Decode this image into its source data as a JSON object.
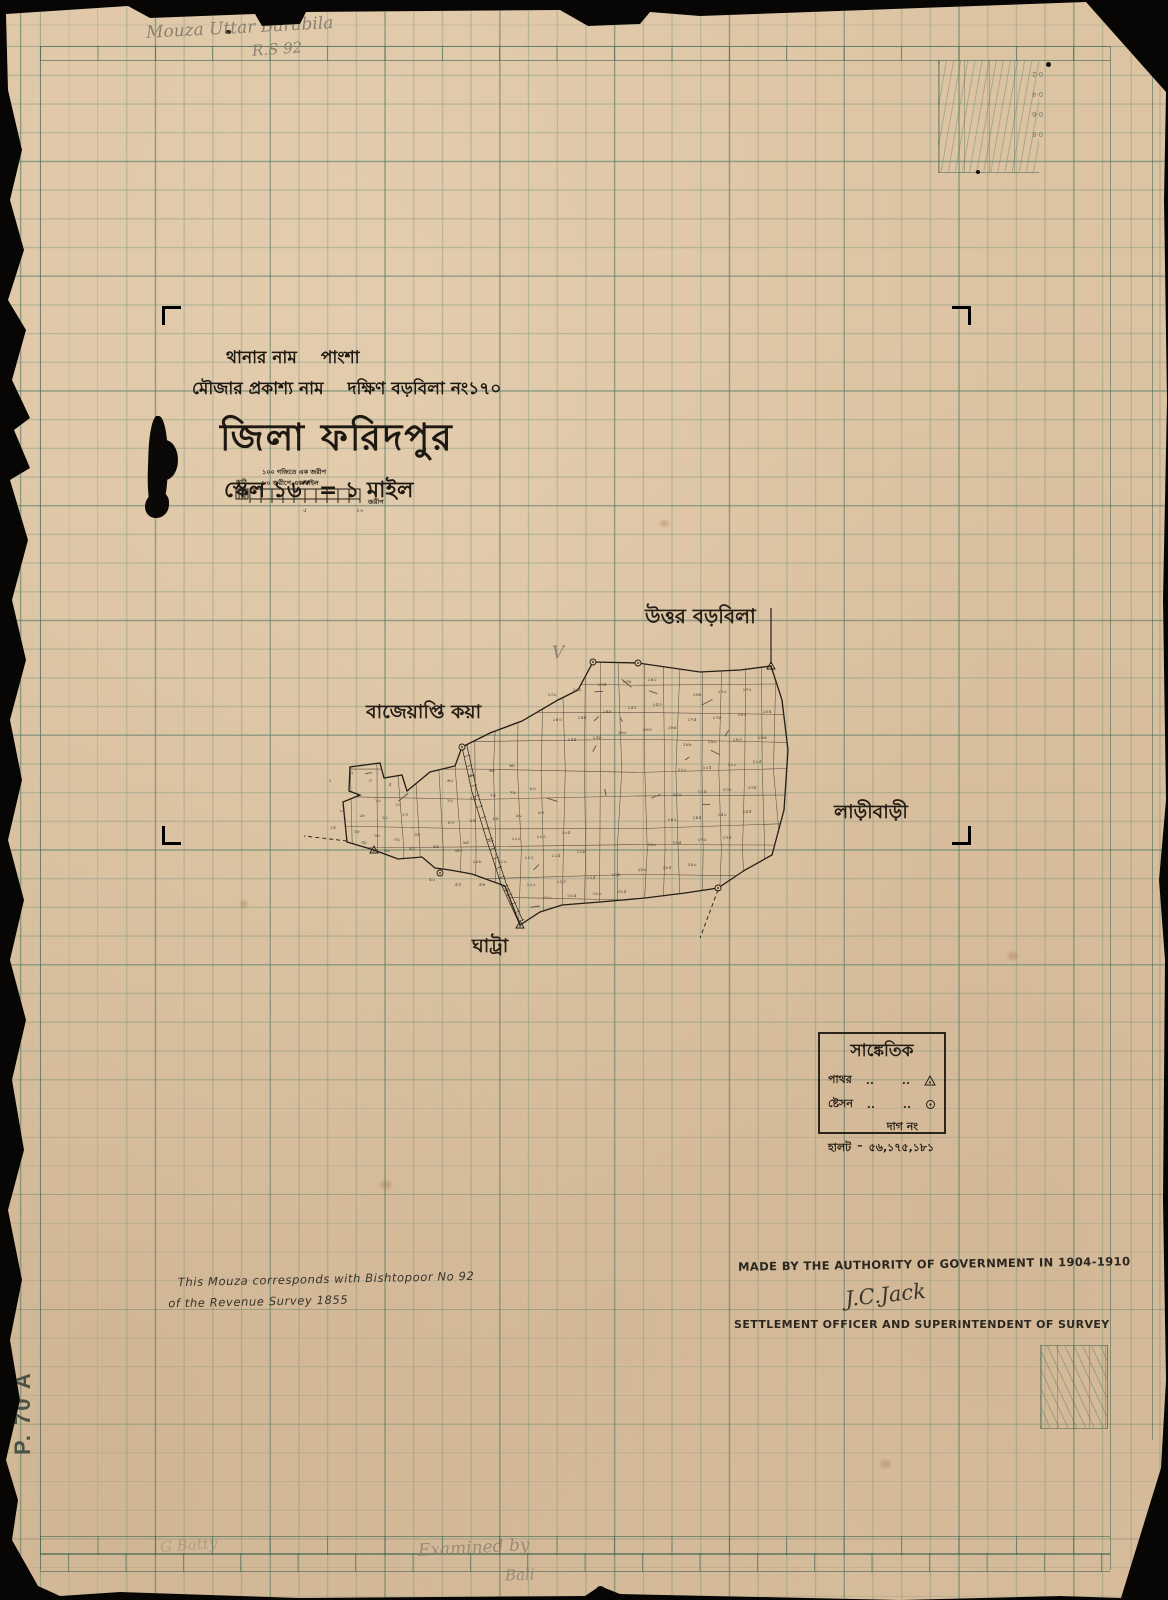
{
  "pencil": {
    "top_line1": "Mouza  Uttar Barabila",
    "top_line2": "R.S 92",
    "check": "V",
    "bottom_faint": "G Batty",
    "bottom_center1": "Examined by",
    "bottom_center2": "Bali"
  },
  "title_block": {
    "line1_label": "থানার নাম",
    "line1_value": "পাংশা",
    "line2_label": "মৌজার প্রকাশ্য নাম",
    "line2_value": "দক্ষিণ বড়বিলা নং১৭০",
    "district": "জিলা ফরিদপুর",
    "scale_line": "স্কেল ১৬″ = ১ মাইল",
    "scale_note1": "১০০ গজিতে এক জরীপ",
    "scale_note2": "৮০ জরীপে এক মাইল",
    "scale_left_label": "কাঠি",
    "scale_right_label": "জরীপ",
    "scale_ticks": [
      "৫",
      "১০"
    ]
  },
  "map": {
    "neighbors": {
      "north": "উত্তর বড়বিলা",
      "west": "বাজেয়াপ্তি কয়া",
      "east": "লাড়ীবাড়ী",
      "south": "ঘাট্রা"
    },
    "plots": [
      {
        "x": 30,
        "y": 182,
        "n": "১"
      },
      {
        "x": 52,
        "y": 174,
        "n": "২"
      },
      {
        "x": 70,
        "y": 182,
        "n": "৩"
      },
      {
        "x": 90,
        "y": 186,
        "n": "৫"
      },
      {
        "x": 58,
        "y": 197,
        "n": "৮"
      },
      {
        "x": 78,
        "y": 202,
        "n": "১০"
      },
      {
        "x": 98,
        "y": 206,
        "n": "১২"
      },
      {
        "x": 42,
        "y": 212,
        "n": "১৫"
      },
      {
        "x": 62,
        "y": 217,
        "n": "১৮"
      },
      {
        "x": 85,
        "y": 219,
        "n": "২১"
      },
      {
        "x": 105,
        "y": 216,
        "n": "২৩"
      },
      {
        "x": 33,
        "y": 229,
        "n": "২৫"
      },
      {
        "x": 57,
        "y": 233,
        "n": "২৮"
      },
      {
        "x": 77,
        "y": 237,
        "n": "৩০"
      },
      {
        "x": 97,
        "y": 241,
        "n": "৩২"
      },
      {
        "x": 117,
        "y": 236,
        "n": "৩৫"
      },
      {
        "x": 64,
        "y": 244,
        "n": "৩৮"
      },
      {
        "x": 87,
        "y": 252,
        "n": "৪০"
      },
      {
        "x": 112,
        "y": 250,
        "n": "৪২"
      },
      {
        "x": 136,
        "y": 248,
        "n": "৪৫"
      },
      {
        "x": 158,
        "y": 252,
        "n": "৪৮"
      },
      {
        "x": 132,
        "y": 281,
        "n": "৫০"
      },
      {
        "x": 158,
        "y": 286,
        "n": "৫৩"
      },
      {
        "x": 182,
        "y": 286,
        "n": "৫৬"
      },
      {
        "x": 207,
        "y": 291,
        "n": "৫৮"
      },
      {
        "x": 150,
        "y": 182,
        "n": "৬০"
      },
      {
        "x": 172,
        "y": 177,
        "n": "৬৩"
      },
      {
        "x": 192,
        "y": 172,
        "n": "৬৫"
      },
      {
        "x": 212,
        "y": 167,
        "n": "৬৮"
      },
      {
        "x": 150,
        "y": 202,
        "n": "৭০"
      },
      {
        "x": 173,
        "y": 200,
        "n": "৭৩"
      },
      {
        "x": 193,
        "y": 197,
        "n": "৭৫"
      },
      {
        "x": 213,
        "y": 194,
        "n": "৭৮"
      },
      {
        "x": 233,
        "y": 190,
        "n": "৮০"
      },
      {
        "x": 151,
        "y": 224,
        "n": "৮৩"
      },
      {
        "x": 173,
        "y": 222,
        "n": "৮৫"
      },
      {
        "x": 196,
        "y": 220,
        "n": "৮৮"
      },
      {
        "x": 219,
        "y": 217,
        "n": "৯০"
      },
      {
        "x": 241,
        "y": 214,
        "n": "৯৩"
      },
      {
        "x": 166,
        "y": 244,
        "n": "৯৫"
      },
      {
        "x": 191,
        "y": 242,
        "n": "৯৮"
      },
      {
        "x": 216,
        "y": 240,
        "n": "১০০"
      },
      {
        "x": 241,
        "y": 238,
        "n": "১০৩"
      },
      {
        "x": 266,
        "y": 234,
        "n": "১০৫"
      },
      {
        "x": 177,
        "y": 263,
        "n": "১০৮"
      },
      {
        "x": 202,
        "y": 263,
        "n": "১১০"
      },
      {
        "x": 229,
        "y": 259,
        "n": "১১২"
      },
      {
        "x": 256,
        "y": 257,
        "n": "১১৫"
      },
      {
        "x": 281,
        "y": 253,
        "n": "১১৮"
      },
      {
        "x": 231,
        "y": 286,
        "n": "১২০"
      },
      {
        "x": 261,
        "y": 283,
        "n": "১২৩"
      },
      {
        "x": 291,
        "y": 279,
        "n": "১২৫"
      },
      {
        "x": 316,
        "y": 276,
        "n": "১২৮"
      },
      {
        "x": 252,
        "y": 96,
        "n": "১৩০"
      },
      {
        "x": 277,
        "y": 91,
        "n": "১৩২"
      },
      {
        "x": 302,
        "y": 86,
        "n": "১৩৫"
      },
      {
        "x": 327,
        "y": 83,
        "n": "১৩৮"
      },
      {
        "x": 352,
        "y": 81,
        "n": "১৪০"
      },
      {
        "x": 257,
        "y": 121,
        "n": "১৪৩"
      },
      {
        "x": 282,
        "y": 119,
        "n": "১৪৫"
      },
      {
        "x": 307,
        "y": 113,
        "n": "১৪৮"
      },
      {
        "x": 332,
        "y": 109,
        "n": "১৫০"
      },
      {
        "x": 357,
        "y": 106,
        "n": "১৫৩"
      },
      {
        "x": 272,
        "y": 141,
        "n": "১৫৫"
      },
      {
        "x": 297,
        "y": 139,
        "n": "১৫৮"
      },
      {
        "x": 322,
        "y": 134,
        "n": "১৬০"
      },
      {
        "x": 347,
        "y": 131,
        "n": "১৬৩"
      },
      {
        "x": 372,
        "y": 129,
        "n": "১৬৫"
      },
      {
        "x": 397,
        "y": 96,
        "n": "১৬৮"
      },
      {
        "x": 422,
        "y": 93,
        "n": "১৭০"
      },
      {
        "x": 447,
        "y": 91,
        "n": "১৭২"
      },
      {
        "x": 392,
        "y": 121,
        "n": "১৭৫"
      },
      {
        "x": 417,
        "y": 119,
        "n": "১৭৮"
      },
      {
        "x": 442,
        "y": 116,
        "n": "১৮১"
      },
      {
        "x": 467,
        "y": 113,
        "n": "১৮৪"
      },
      {
        "x": 387,
        "y": 146,
        "n": "১৮৮"
      },
      {
        "x": 412,
        "y": 143,
        "n": "১৯০"
      },
      {
        "x": 437,
        "y": 141,
        "n": "১৯৩"
      },
      {
        "x": 462,
        "y": 139,
        "n": "১৯৬"
      },
      {
        "x": 382,
        "y": 171,
        "n": "২০০"
      },
      {
        "x": 407,
        "y": 169,
        "n": "২০৫"
      },
      {
        "x": 432,
        "y": 166,
        "n": "২১০"
      },
      {
        "x": 457,
        "y": 163,
        "n": "২১৫"
      },
      {
        "x": 377,
        "y": 196,
        "n": "২২০"
      },
      {
        "x": 402,
        "y": 193,
        "n": "২২৫"
      },
      {
        "x": 427,
        "y": 191,
        "n": "২৩০"
      },
      {
        "x": 452,
        "y": 189,
        "n": "২৩৫"
      },
      {
        "x": 372,
        "y": 221,
        "n": "২৪০"
      },
      {
        "x": 397,
        "y": 219,
        "n": "২৪৫"
      },
      {
        "x": 422,
        "y": 216,
        "n": "২৫০"
      },
      {
        "x": 447,
        "y": 213,
        "n": "২৫৫"
      },
      {
        "x": 352,
        "y": 246,
        "n": "২৬০"
      },
      {
        "x": 377,
        "y": 244,
        "n": "২৬৫"
      },
      {
        "x": 402,
        "y": 241,
        "n": "২৭০"
      },
      {
        "x": 427,
        "y": 239,
        "n": "২৭৫"
      },
      {
        "x": 342,
        "y": 271,
        "n": "২৮০"
      },
      {
        "x": 367,
        "y": 269,
        "n": "২৮৫"
      },
      {
        "x": 392,
        "y": 266,
        "n": "২৯০"
      },
      {
        "x": 247,
        "y": 299,
        "n": "৩০০"
      },
      {
        "x": 272,
        "y": 297,
        "n": "৩০৫"
      },
      {
        "x": 297,
        "y": 295,
        "n": "৩১০"
      },
      {
        "x": 322,
        "y": 293,
        "n": "৩১৫"
      }
    ]
  },
  "legend": {
    "title": "সাঙ্কেতিক",
    "leader": "..",
    "rows": [
      {
        "label": "পাথর",
        "symbol": "triangle-dot"
      },
      {
        "label": "ষ্টেসন",
        "symbol": "circle-dot"
      }
    ],
    "dag_label": "দাগ নং",
    "halt_label": "হালট",
    "halt_sep": "–",
    "halt_value": "৫৬,১৭৫,১৮১"
  },
  "notes": {
    "revenue_line1": "This Mouza corresponds with Bishtopoor No 92",
    "revenue_line2": "of the Revenue Survey 1855",
    "authority": "MADE BY THE AUTHORITY OF GOVERNMENT IN 1904-1910",
    "signature": "J.C.Jack",
    "officer": "SETTLEMENT OFFICER AND SUPERINTENDENT OF SURVEY"
  },
  "sheet_number": "P. 70 A",
  "corner_scale_labels": [
    "0·2",
    "0·4",
    "0·6",
    "0·8"
  ],
  "colors": {
    "paper": "#dcc3a2",
    "grid": "#60866e",
    "ink": "#211c15",
    "pencil": "#8b8070"
  }
}
